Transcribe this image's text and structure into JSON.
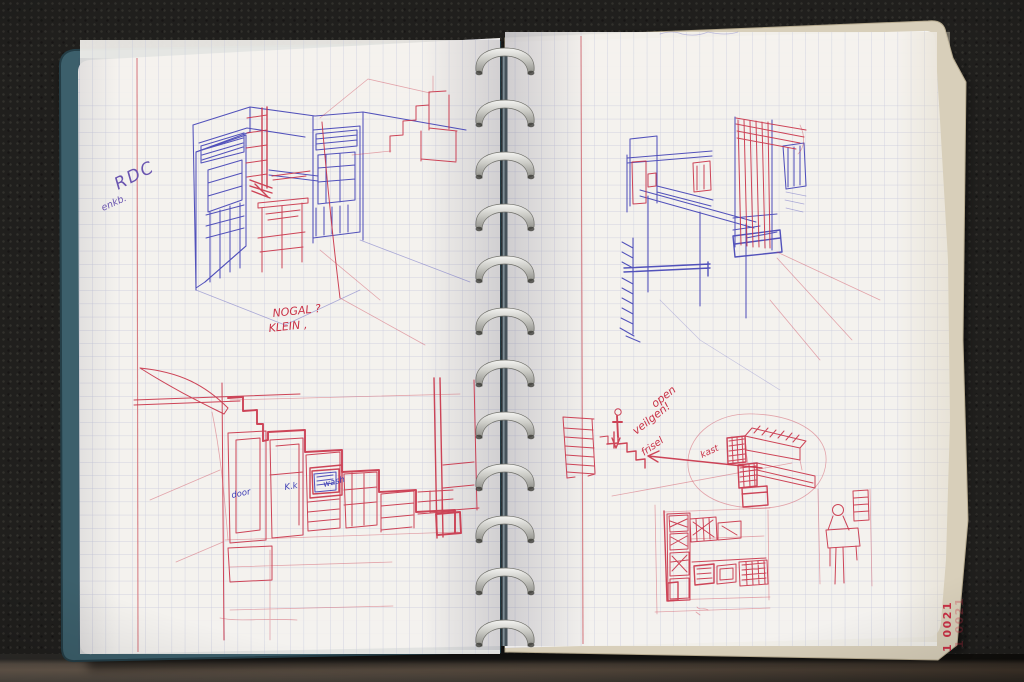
{
  "scene": {
    "description": "Photograph of an open disc-bound sketchbook with squared (grid) paper, two pages of hand-drawn interior and staircase sketches in blue and red ballpoint pen",
    "page_number_label": "1 0021"
  },
  "annotations": {
    "rdc": {
      "main": "RDC",
      "sub": "enkb."
    },
    "nogal": {
      "line1": "NOGAL ?",
      "line2": "KLEIN ,"
    },
    "note": {
      "line1": "open",
      "line2": "veilgen!",
      "line3": "frisel"
    },
    "kast": "kast",
    "stair_labels": {
      "left": "door",
      "middle": "K.k",
      "right": "wash"
    }
  },
  "colors": {
    "bg": "#201f1d",
    "paper": "#f4f2ee",
    "grid_line": "#c6c8dc",
    "margin_red": "#d87f85",
    "red_ink": "#c93247",
    "blue_ink": "#3c3cb4",
    "violet_ink": "#6a55b0",
    "cover_teal": "#3c5f6b",
    "cream": "#d8cfba",
    "ring_silver": "#d9d9d5",
    "table_brown": "#564739"
  }
}
